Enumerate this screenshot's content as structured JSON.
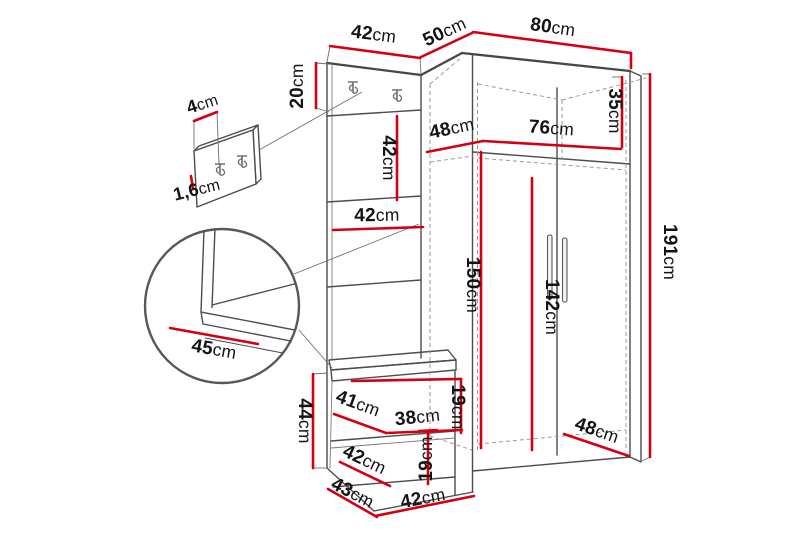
{
  "colors": {
    "dimension_red": "#d40011",
    "outline_gray": "#4d4d4d",
    "dashed_gray": "#9a9a9a",
    "label_black": "#141414",
    "background": "#ffffff"
  },
  "diagram": {
    "type": "furniture-dimension-drawing",
    "subject": "hallway wardrobe set with coat panel, mirror, bench and corner wardrobe",
    "dimensions": {
      "panel_width_top": {
        "value": "42",
        "unit": "cm"
      },
      "corner_depth_top": {
        "value": "50",
        "unit": "cm"
      },
      "wardrobe_width": {
        "value": "80",
        "unit": "cm"
      },
      "hook_strip_height": {
        "value": "20",
        "unit": "cm"
      },
      "detail_panel_depth": {
        "value": "4",
        "unit": "cm"
      },
      "detail_panel_thickness": {
        "value": "1,6",
        "unit": "cm"
      },
      "wardrobe_side_depth_top": {
        "value": "48",
        "unit": "cm"
      },
      "wardrobe_inner_width": {
        "value": "76",
        "unit": "cm"
      },
      "top_shelf_height": {
        "value": "35",
        "unit": "cm"
      },
      "mirror_height": {
        "value": "42",
        "unit": "cm"
      },
      "shelf_width": {
        "value": "42",
        "unit": "cm"
      },
      "interior_height": {
        "value": "150",
        "unit": "cm"
      },
      "door_height": {
        "value": "142",
        "unit": "cm"
      },
      "total_height": {
        "value": "191",
        "unit": "cm"
      },
      "seat_depth_detail": {
        "value": "45",
        "unit": "cm"
      },
      "bench_height": {
        "value": "44",
        "unit": "cm"
      },
      "bench_diagonal_depth": {
        "value": "41",
        "unit": "cm"
      },
      "bench_inner_width": {
        "value": "38",
        "unit": "cm"
      },
      "upper_niche_height": {
        "value": "19",
        "unit": "cm"
      },
      "lower_niche_height": {
        "value": "19",
        "unit": "cm"
      },
      "bench_depth": {
        "value": "42",
        "unit": "cm"
      },
      "bench_side_depth": {
        "value": "43",
        "unit": "cm"
      },
      "bench_width": {
        "value": "42",
        "unit": "cm"
      },
      "wardrobe_side_depth_bottom": {
        "value": "48",
        "unit": "cm"
      }
    }
  }
}
